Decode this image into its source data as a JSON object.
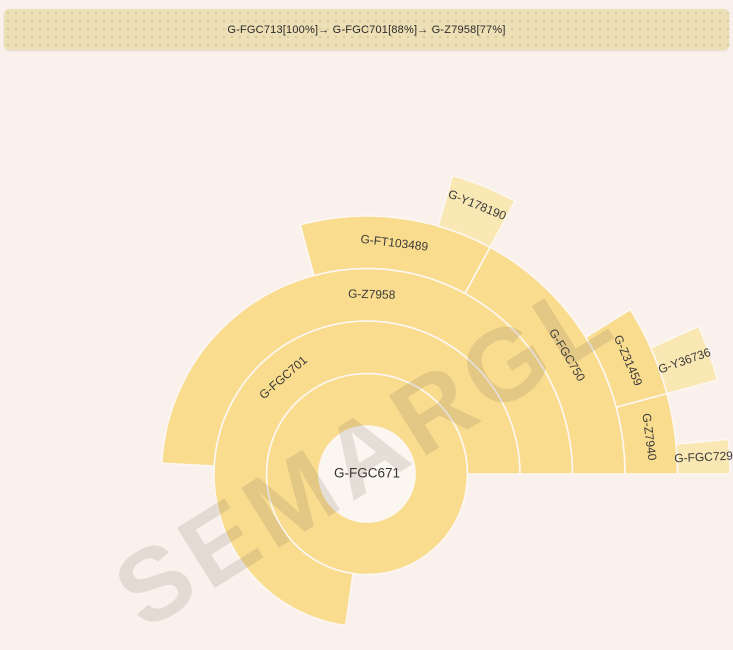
{
  "breadcrumb": {
    "items": [
      "G-FGC713[100%]",
      "G-FGC701[88%]",
      "G-Z7958[77%]"
    ],
    "separator": "→ ",
    "text": "G-FGC713[100%]→ G-FGC701[88%]→ G-Z7958[77%]"
  },
  "watermark": "SEMARGL",
  "colors": {
    "background": "#faf1ec",
    "bar_background": "#eddfb6",
    "segment_normal": "#fadc8e",
    "segment_light": "#fae8b4",
    "segment_stroke": "#fcf7f2",
    "center_fill": "#fcf6f0",
    "label": "#3a3a3a"
  },
  "chart_data": {
    "type": "sunburst",
    "title": "",
    "center": {
      "label": "G-FGC671"
    },
    "legend": "none",
    "rings_total": 6,
    "segments": [
      {
        "label": "",
        "ring": 1,
        "start_deg": -180,
        "end_deg": 180,
        "shade": "normal",
        "label_mode": "none",
        "label_r": 0
      },
      {
        "label": "G-FGC701",
        "ring": 2,
        "start_deg": -172,
        "end_deg": 90,
        "shade": "normal",
        "label_mode": "tangent",
        "label_r": 127
      },
      {
        "label": "G-Z7958",
        "ring": 3,
        "start_deg": -87,
        "end_deg": 90,
        "shade": "normal",
        "label_mode": "tangent",
        "label_r": 179
      },
      {
        "label": "G-FT103489",
        "ring": 4,
        "start_deg": -15,
        "end_deg": 28.5,
        "shade": "normal",
        "label_mode": "tangent",
        "label_r": 232
      },
      {
        "label": "G-FGC750",
        "ring": 4,
        "start_deg": 28.5,
        "end_deg": 90,
        "shade": "normal",
        "label_mode": "tangent",
        "label_r": 232
      },
      {
        "label": "G-Y178190",
        "ring": 5,
        "start_deg": 16,
        "end_deg": 28.5,
        "shade": "light",
        "label_mode": "tangent",
        "label_r": 290
      },
      {
        "label": "G-Z31459",
        "ring": 5,
        "start_deg": 58,
        "end_deg": 75,
        "shade": "normal",
        "label_mode": "tangent",
        "label_r": 284
      },
      {
        "label": "G-Z7940",
        "ring": 5,
        "start_deg": 75,
        "end_deg": 90,
        "shade": "normal",
        "label_mode": "tangent",
        "label_r": 284
      },
      {
        "label": "G-Y36736",
        "ring": 6,
        "start_deg": 66,
        "end_deg": 75,
        "shade": "light",
        "label_mode": "radial",
        "label_r": 337
      },
      {
        "label": "G-FGC729",
        "ring": 6,
        "start_deg": 84.5,
        "end_deg": 90,
        "shade": "light",
        "label_mode": "radial",
        "label_r": 337
      }
    ],
    "layout_hints": {
      "center_x": 367,
      "center_y": 474,
      "center_radius": 48,
      "ring_width": 52.5,
      "angles_clockwise_from_top": true
    }
  }
}
